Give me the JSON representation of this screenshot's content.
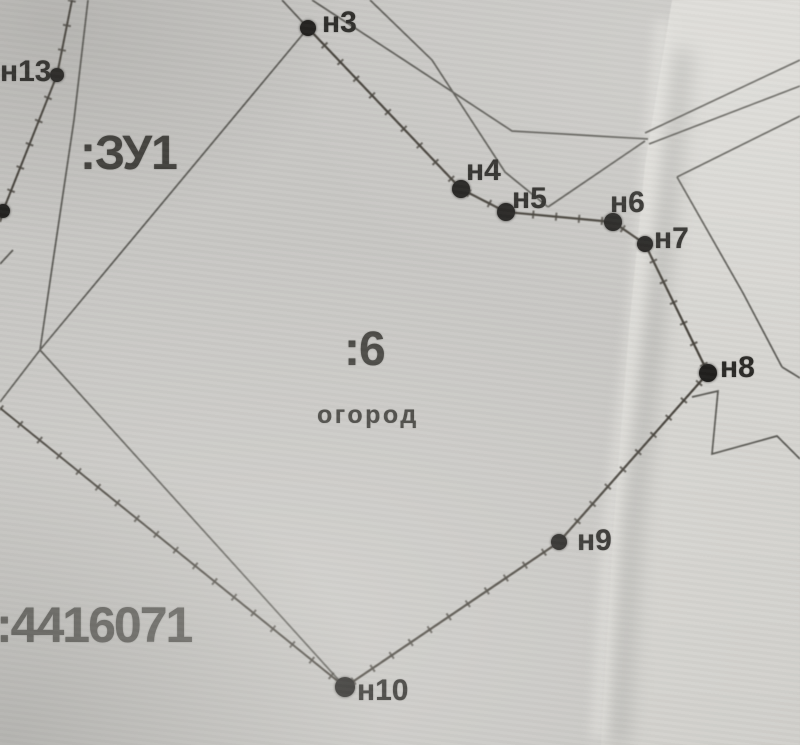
{
  "map": {
    "labels": {
      "zu1": ":ЗУ1",
      "parcel6": ":6",
      "land_use": "огород",
      "cadastral_number": ":4416071"
    },
    "points": [
      {
        "id": "n13",
        "label": "н13",
        "x": 57,
        "y": 75,
        "r": 7,
        "lx": 0,
        "ly": 57
      },
      {
        "id": "edge-point",
        "label": "",
        "x": 3,
        "y": 211,
        "r": 7,
        "lx": 0,
        "ly": 0
      },
      {
        "id": "n3",
        "label": "н3",
        "x": 308,
        "y": 28,
        "r": 8,
        "lx": 322,
        "ly": 8
      },
      {
        "id": "n4",
        "label": "н4",
        "x": 461,
        "y": 189,
        "r": 9,
        "lx": 466,
        "ly": 156
      },
      {
        "id": "n5",
        "label": "н5",
        "x": 506,
        "y": 212,
        "r": 9,
        "lx": 512,
        "ly": 184
      },
      {
        "id": "n6",
        "label": "н6",
        "x": 613,
        "y": 222,
        "r": 9,
        "lx": 610,
        "ly": 188
      },
      {
        "id": "n7",
        "label": "н7",
        "x": 645,
        "y": 244,
        "r": 8,
        "lx": 654,
        "ly": 224
      },
      {
        "id": "n8",
        "label": "н8",
        "x": 708,
        "y": 373,
        "r": 9,
        "lx": 720,
        "ly": 353
      },
      {
        "id": "n9",
        "label": "н9",
        "x": 559,
        "y": 542,
        "r": 8,
        "lx": 577,
        "ly": 526
      },
      {
        "id": "n10",
        "label": "н10",
        "x": 345,
        "y": 687,
        "r": 10,
        "lx": 357,
        "ly": 676
      }
    ]
  }
}
